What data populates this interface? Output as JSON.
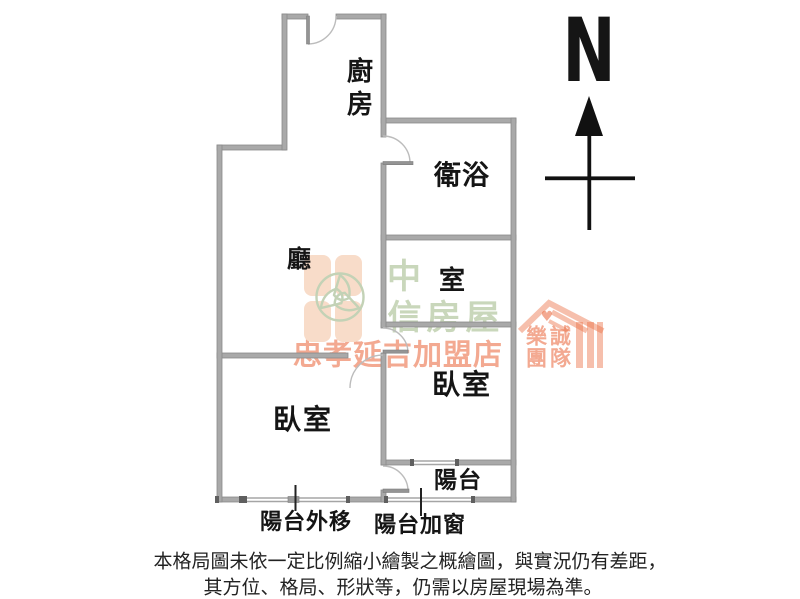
{
  "floor_plan": {
    "rooms": {
      "kitchen": "廚房",
      "bathroom": "衛浴",
      "living_room": "廳",
      "room": "室",
      "bedroom_left": "臥室",
      "bedroom_right": "臥室",
      "balcony": "陽台"
    },
    "annotations": {
      "balcony_extended": "陽台外移",
      "balcony_window_added": "陽台加窗"
    },
    "compass": {
      "north": "N"
    },
    "watermark": {
      "brand": "中信房屋",
      "brand_top": "中",
      "brand_bottom": "信房屋",
      "store": "忠孝延吉加盟店",
      "team_top": "樂誠",
      "team_bottom": "團隊",
      "heart": "♥"
    },
    "disclaimer": {
      "line1": "本格局圖未依一定比例縮小繪製之概繪圖，與實況仍有差距，",
      "line2": "其方位、格局、形狀等，仍需以房屋現場為準。"
    },
    "colors": {
      "wall_gray": "#a9a9a9",
      "wall_edge": "#8a8a8a",
      "wall_cap_dark": "#5f5f5f",
      "door_arc": "#b8b8b8",
      "label_black": "#151515",
      "watermark_green": "#c9d7bb",
      "watermark_orange": "#eb7048",
      "petal_orange": "#f8dcc9"
    }
  }
}
